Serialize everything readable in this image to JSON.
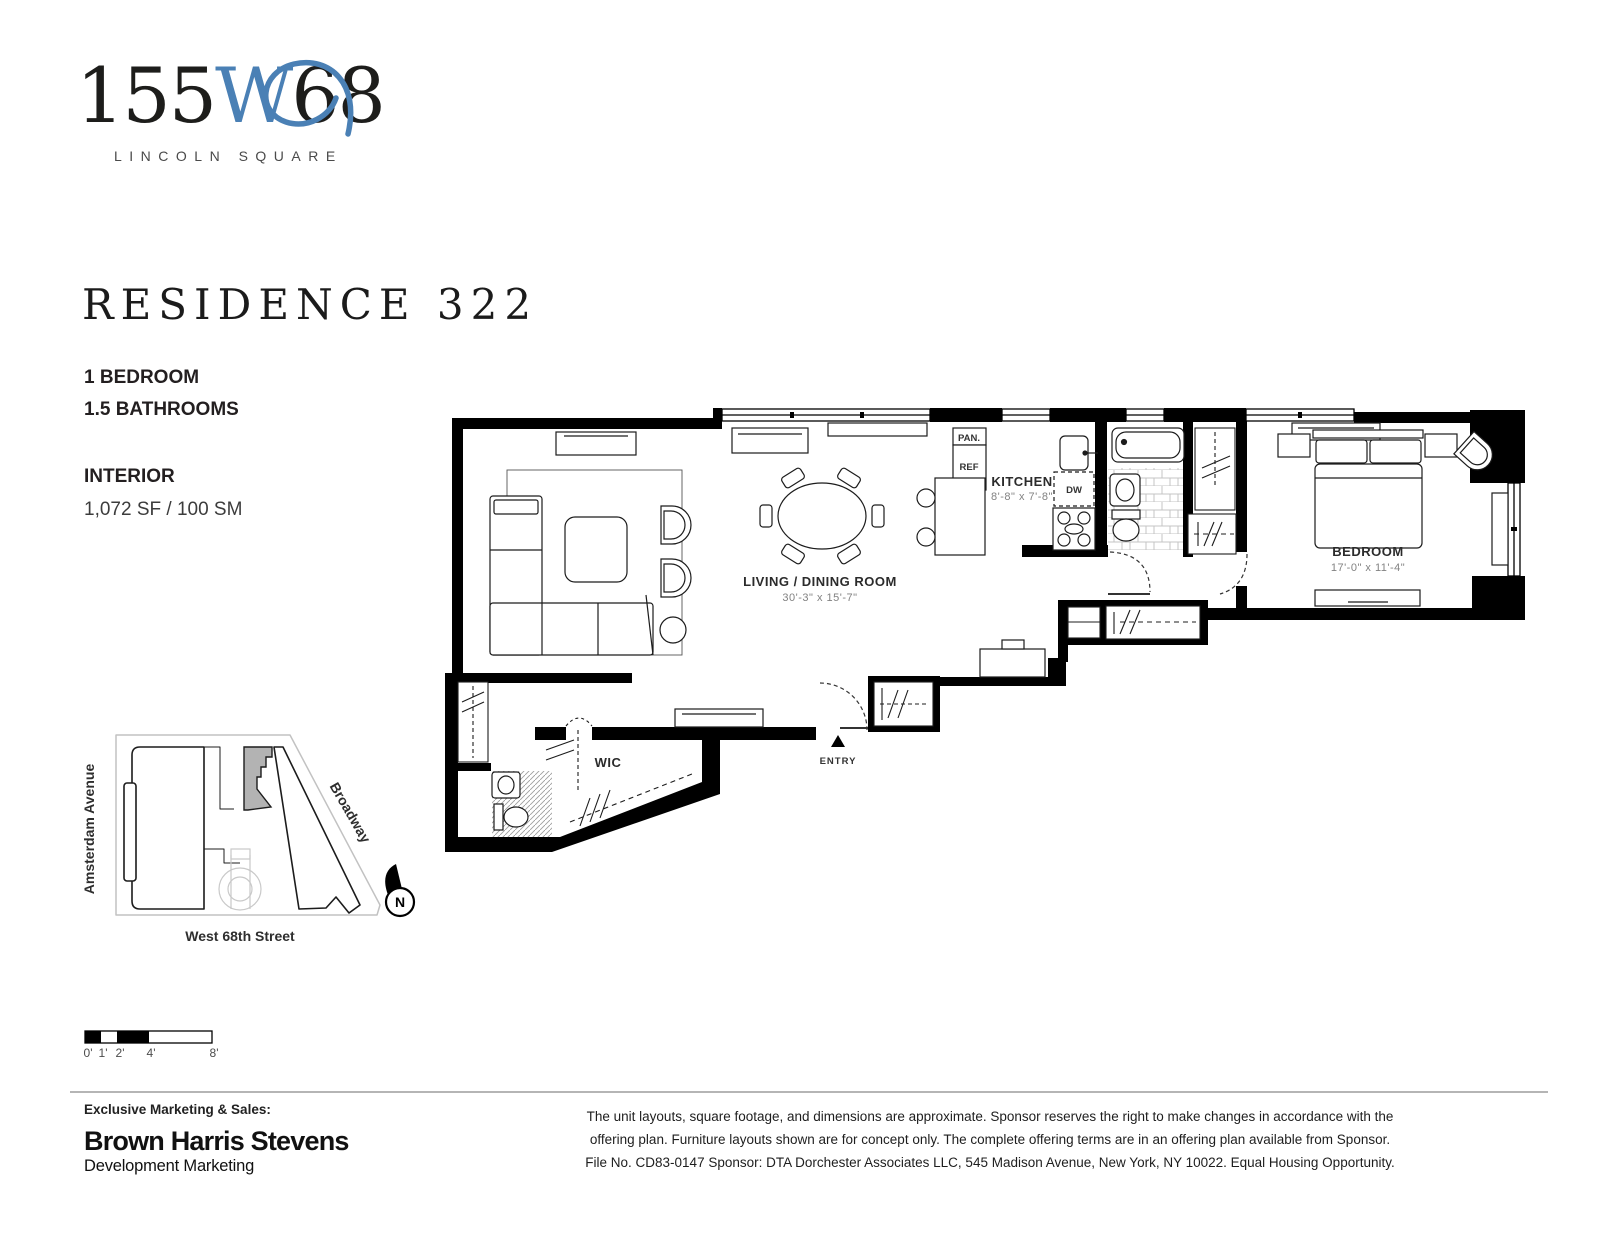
{
  "brand": {
    "logo_prefix": "155",
    "logo_w": "W",
    "logo_suffix": "68",
    "tagline": "LINCOLN SQUARE",
    "accent_color": "#4a80b5"
  },
  "residence": {
    "title": "RESIDENCE 322",
    "spec_line_1": "1 BEDROOM",
    "spec_line_2": "1.5 BATHROOMS",
    "interior_label": "INTERIOR",
    "interior_area": "1,072 SF / 100 SM"
  },
  "floorplan": {
    "living": {
      "name": "LIVING / DINING ROOM",
      "dims": "30'-3\" x 15'-7\""
    },
    "kitchen": {
      "name": "KITCHEN",
      "dims": "8'-8\" x 7'-8\""
    },
    "bedroom": {
      "name": "BEDROOM",
      "dims": "17'-0\" x 11'-4\""
    },
    "wic": "WIC",
    "entry": "ENTRY",
    "pantry": "PAN.",
    "refrigerator": "REF",
    "dishwasher": "DW"
  },
  "sitemap": {
    "street_left": "Amsterdam Avenue",
    "street_right": "Broadway",
    "street_bottom": "West 68th Street",
    "north_label": "N",
    "unit_fill": "#b3b3b3"
  },
  "scalebar": {
    "tick_0": "0'",
    "tick_1": "1'",
    "tick_2": "2'",
    "tick_4": "4'",
    "tick_8": "8'"
  },
  "footer": {
    "sales_label": "Exclusive Marketing & Sales:",
    "brokerage_name": "Brown Harris Stevens",
    "brokerage_division": "Development Marketing",
    "disclaimer_line_1": "The unit layouts, square footage, and dimensions are approximate. Sponsor reserves the right to make changes in accordance with the",
    "disclaimer_line_2": "offering plan. Furniture layouts shown are for concept only. The complete offering terms are in an offering plan available from Sponsor.",
    "disclaimer_line_3": "File No. CD83-0147 Sponsor: DTA Dorchester Associates LLC, 545 Madison Avenue, New York, NY 10022. Equal Housing Opportunity."
  }
}
